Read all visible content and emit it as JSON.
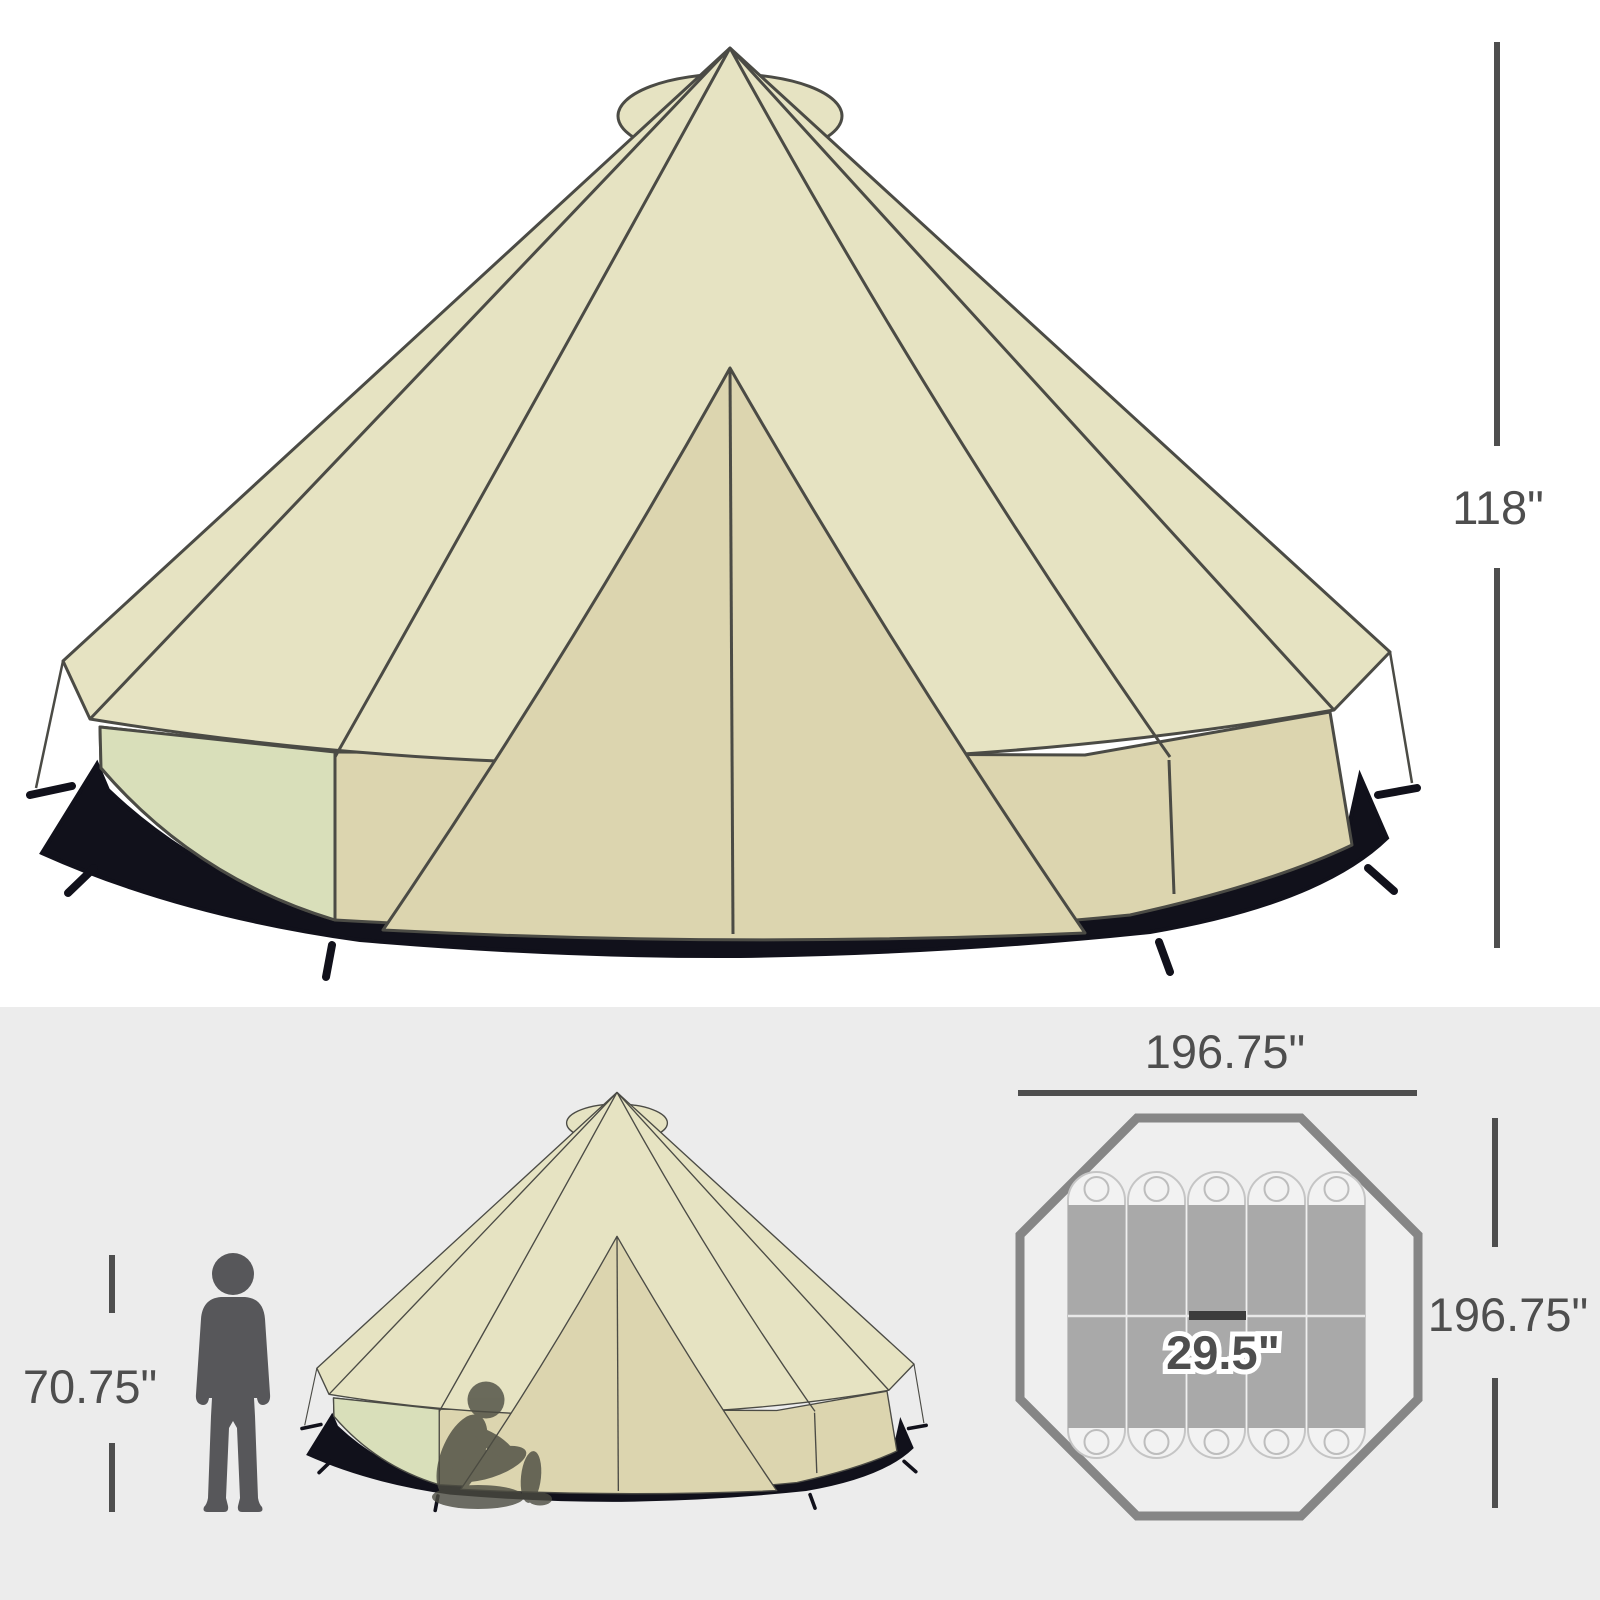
{
  "title": "Bell tent product dimension diagram",
  "front_view": {
    "height_label": "118\""
  },
  "scale_view": {
    "person_height_label": "70.75\""
  },
  "floor_plan": {
    "width_label": "196.75\"",
    "depth_label": "196.75\"",
    "mat_width_label": "29.5\"",
    "sleeping_mat_count": 5,
    "shape": "octagon"
  },
  "colors": {
    "bg_top": "#ffffff",
    "bg_bottom": "#ececec",
    "roof": "#e6e3c2",
    "panel": "#dcd5af",
    "panel_green": "#d9dfba",
    "skirt": "#11111b",
    "outline": "#4b4b45",
    "dim": "#4e4e4e",
    "plan_stroke": "#868686",
    "plan_fill": "#efefef",
    "mat_dark": "#a9a9a9",
    "mat_light": "#f2f2f2",
    "mat_stroke": "#c5c5c5",
    "person": "#57575a",
    "person_seated": "#4b4b41"
  }
}
